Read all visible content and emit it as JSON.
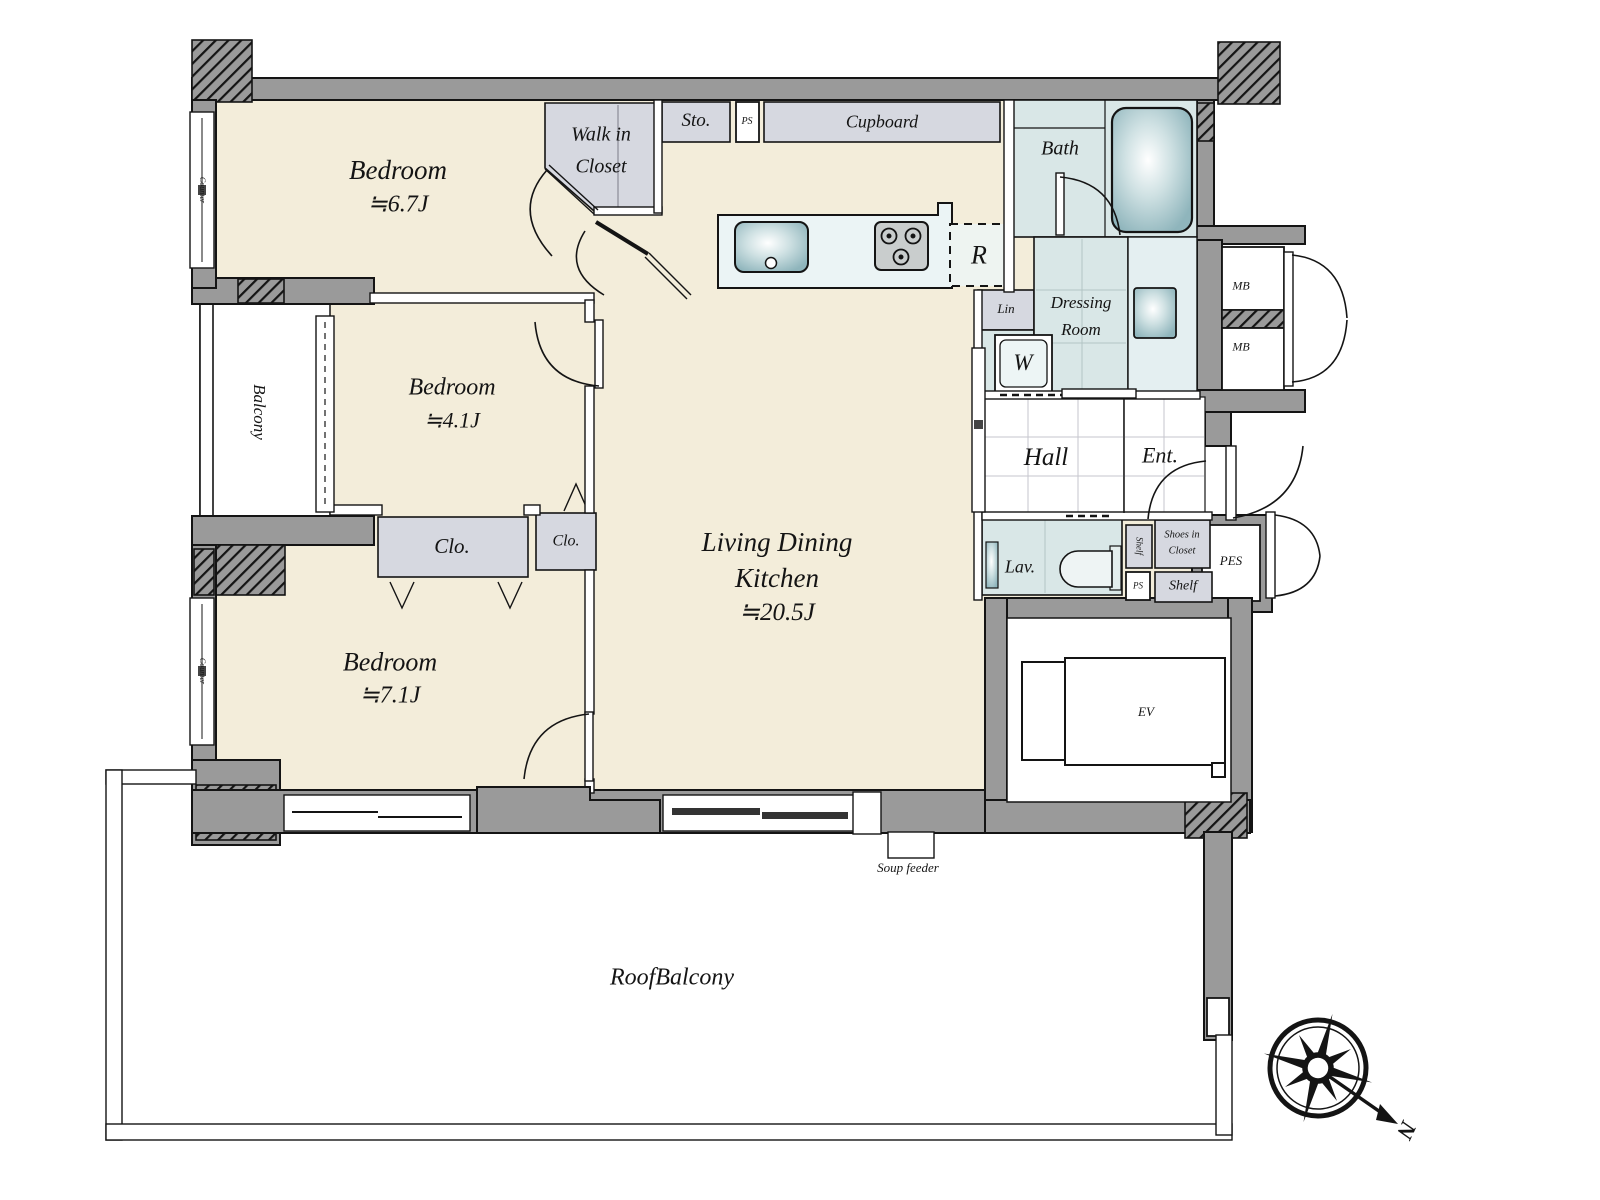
{
  "colors": {
    "wall": "#9a9a9a",
    "floor": "#f3edda",
    "closet": "#d6d8e0",
    "wet": "#d9e7e7",
    "counter": "#ebf4f5",
    "fixture": "#9cbec5",
    "line": "#141414"
  },
  "rooms": {
    "bedroom_top": {
      "name": "Bedroom",
      "area": "≒6.7J"
    },
    "bedroom_mid": {
      "name": "Bedroom",
      "area": "≒4.1J"
    },
    "bedroom_bottom": {
      "name": "Bedroom",
      "area": "≒7.1J"
    },
    "ldk": {
      "line1": "Living Dining",
      "line2": "Kitchen",
      "area": "≒20.5J"
    },
    "walk_in_closet": {
      "line1": "Walk in",
      "line2": "Closet"
    },
    "bath": "Bath",
    "dressing": {
      "line1": "Dressing",
      "line2": "Room"
    },
    "hall": "Hall",
    "entrance": "Ent.",
    "lavatory": "Lav.",
    "balcony": "Balcony",
    "roof_balcony": "RoofBalcony"
  },
  "storage": {
    "sto": "Sto.",
    "cupboard": "Cupboard",
    "closet1": "Clo.",
    "closet2": "Clo.",
    "lin": "Lin",
    "shelf_vertical": "Shelf",
    "shoes_in_closet": {
      "line1": "Shoes in",
      "line2": "Closet"
    },
    "shelf": "Shelf"
  },
  "utility": {
    "ps_top": "PS",
    "ps_bottom": "PS",
    "mb_top": "MB",
    "mb_bottom": "MB",
    "pes": "PES",
    "ev": "EV",
    "washer": "W",
    "fridge": "R",
    "soup_feeder": "Soup feeder",
    "counter_top": "Counter",
    "counter_bottom": "Counter"
  },
  "compass": {
    "north": "N"
  }
}
